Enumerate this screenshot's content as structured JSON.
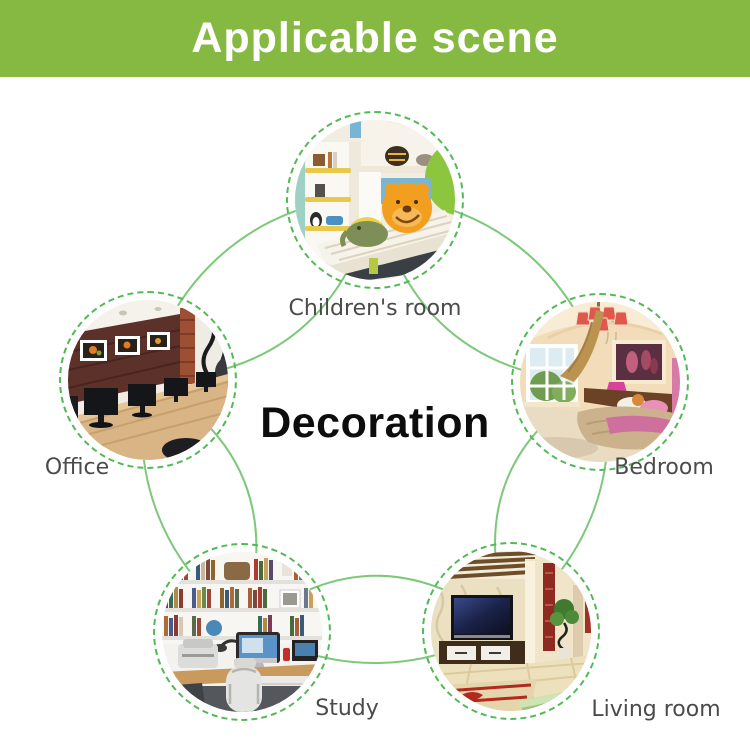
{
  "header": {
    "title": "Applicable scene"
  },
  "center": {
    "title": "Decoration"
  },
  "scenes": [
    {
      "id": "childrens-room",
      "label": "Children's room"
    },
    {
      "id": "office",
      "label": "Office"
    },
    {
      "id": "bedroom",
      "label": "Bedroom"
    },
    {
      "id": "study",
      "label": "Study"
    },
    {
      "id": "living-room",
      "label": "Living room"
    }
  ],
  "colors": {
    "banner_green": "#86b942",
    "banner_text": "#ffffff",
    "arc_green": "#7dc87a",
    "ring_green": "#53b955",
    "label_gray": "#4b4b4b",
    "title_black": "#0d0d0d"
  }
}
